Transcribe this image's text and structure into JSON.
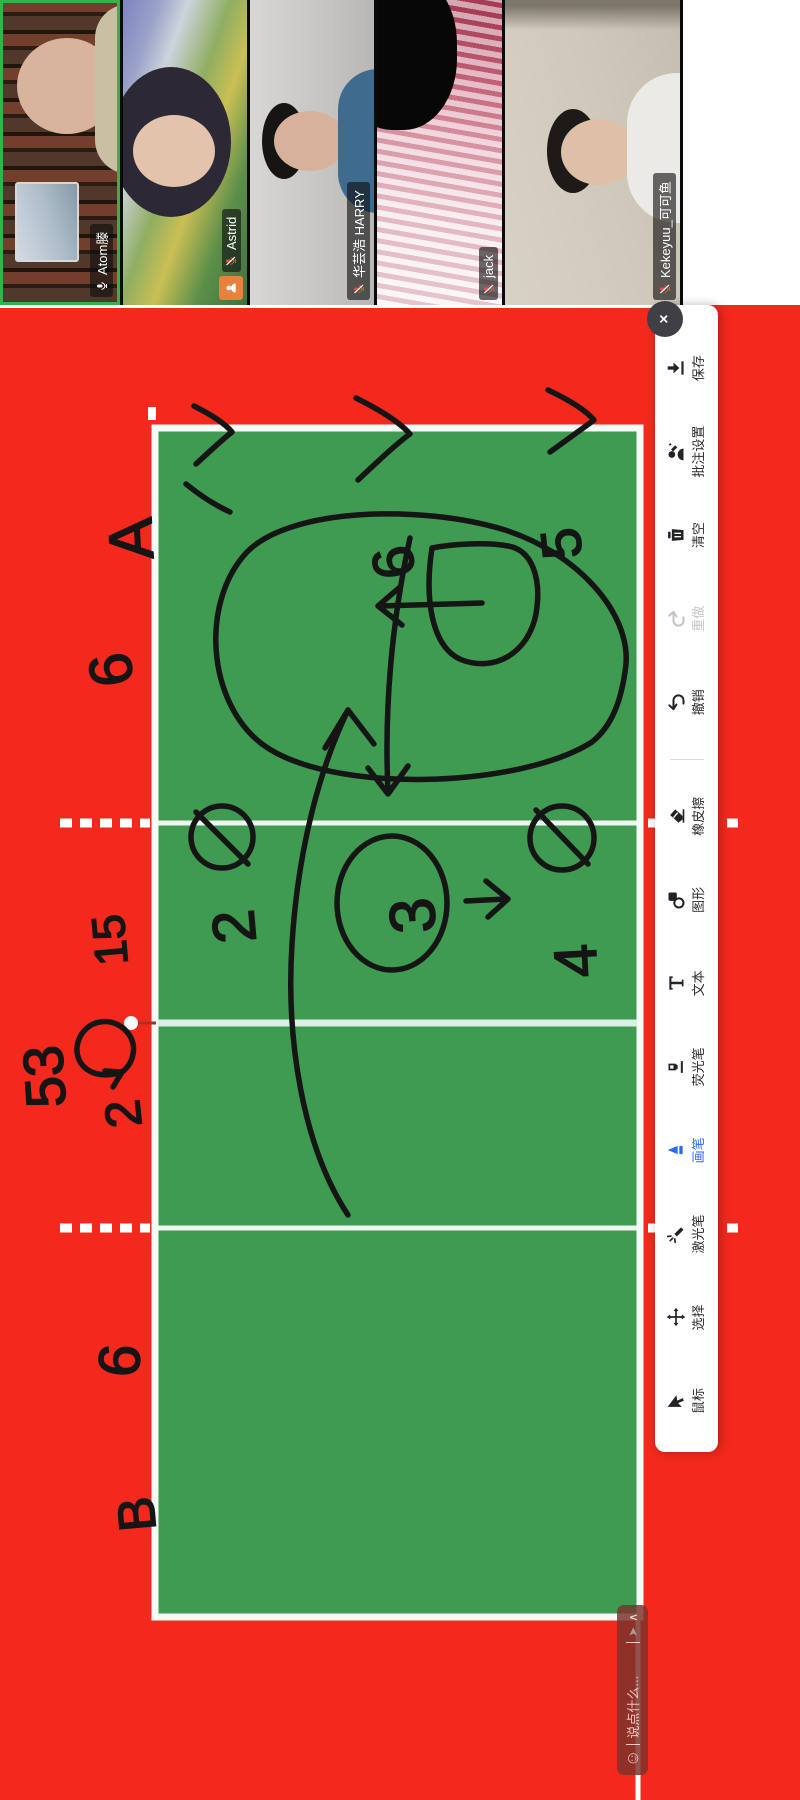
{
  "participants": [
    {
      "name": "Atom滕",
      "muted": false,
      "active_speaker": true
    },
    {
      "name": "Astrid",
      "muted": true,
      "has_host_badge": true
    },
    {
      "name": "华芸浩 HARRY",
      "muted": true
    },
    {
      "name": "jack",
      "muted": true
    },
    {
      "name": "Kekeyuu_可可鱼",
      "muted": true
    }
  ],
  "toolbar": {
    "close_label": "×",
    "items": [
      {
        "id": "mouse",
        "label": "鼠标",
        "state": "normal"
      },
      {
        "id": "select",
        "label": "选择",
        "state": "normal"
      },
      {
        "id": "laser",
        "label": "激光笔",
        "state": "normal"
      },
      {
        "id": "pen",
        "label": "画笔",
        "state": "active"
      },
      {
        "id": "highlighter",
        "label": "荧光笔",
        "state": "normal"
      },
      {
        "id": "text",
        "label": "文本",
        "state": "normal"
      },
      {
        "id": "shape",
        "label": "图形",
        "state": "normal"
      },
      {
        "id": "eraser",
        "label": "橡皮擦",
        "state": "normal"
      },
      {
        "id": "undo",
        "label": "撤销",
        "state": "normal"
      },
      {
        "id": "redo",
        "label": "重做",
        "state": "disabled"
      },
      {
        "id": "clear",
        "label": "清空",
        "state": "normal"
      },
      {
        "id": "annotation-settings",
        "label": "批注设置",
        "state": "normal"
      },
      {
        "id": "save",
        "label": "保存",
        "state": "normal"
      }
    ]
  },
  "chat": {
    "placeholder": "说点什么...",
    "send_icon": "send-arrow",
    "collapse_icon": "chevron"
  },
  "board": {
    "description": "volleyball court tactic sketch drawn in black marker",
    "labels": {
      "team_a": "A",
      "team_b": "B",
      "n53": "53",
      "n2rot": "2",
      "n15": "15",
      "n6_top": "6",
      "n6_mid": "6",
      "n6_left": "6",
      "n5": "5",
      "n2": "2",
      "n3": "3",
      "n4": "4"
    }
  },
  "colors": {
    "canvas_red": "#f2291c",
    "court_green": "#3f9b51",
    "court_line_white": "#f4faf5",
    "net_line": "#d9f1e3",
    "accent_blue": "#2a6af2",
    "active_border_green": "#35b24a",
    "badge_orange": "#e8813c",
    "muted_mic_red": "#e05044",
    "ink_black": "#151515"
  }
}
